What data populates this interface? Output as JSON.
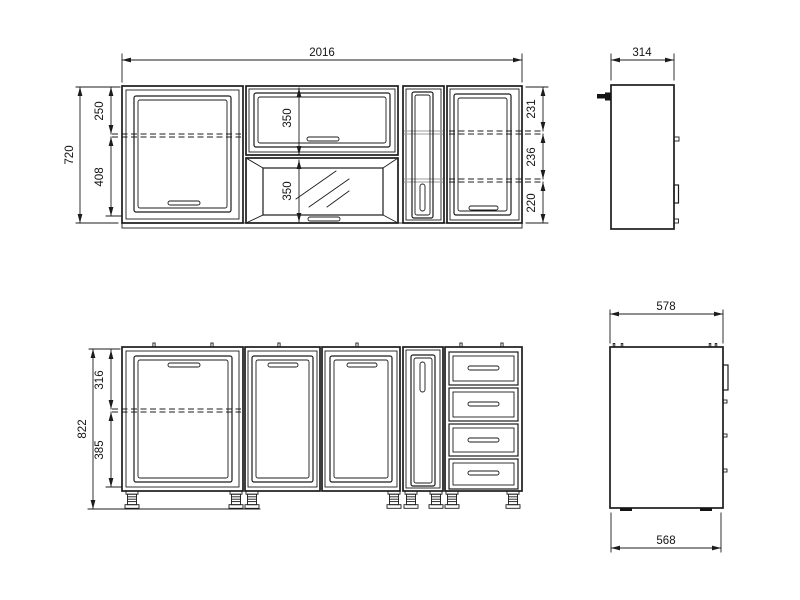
{
  "wall": {
    "total_width": "2016",
    "total_height": "720",
    "left_top": "250",
    "left_bottom": "408",
    "mid_top": "350",
    "mid_bottom": "350",
    "right_top": "231",
    "right_mid": "236",
    "right_bottom": "220",
    "side_depth": "314"
  },
  "base": {
    "total_height": "822",
    "top_section": "316",
    "bottom_section": "385",
    "side_depth": "578",
    "side_bottom": "568"
  }
}
